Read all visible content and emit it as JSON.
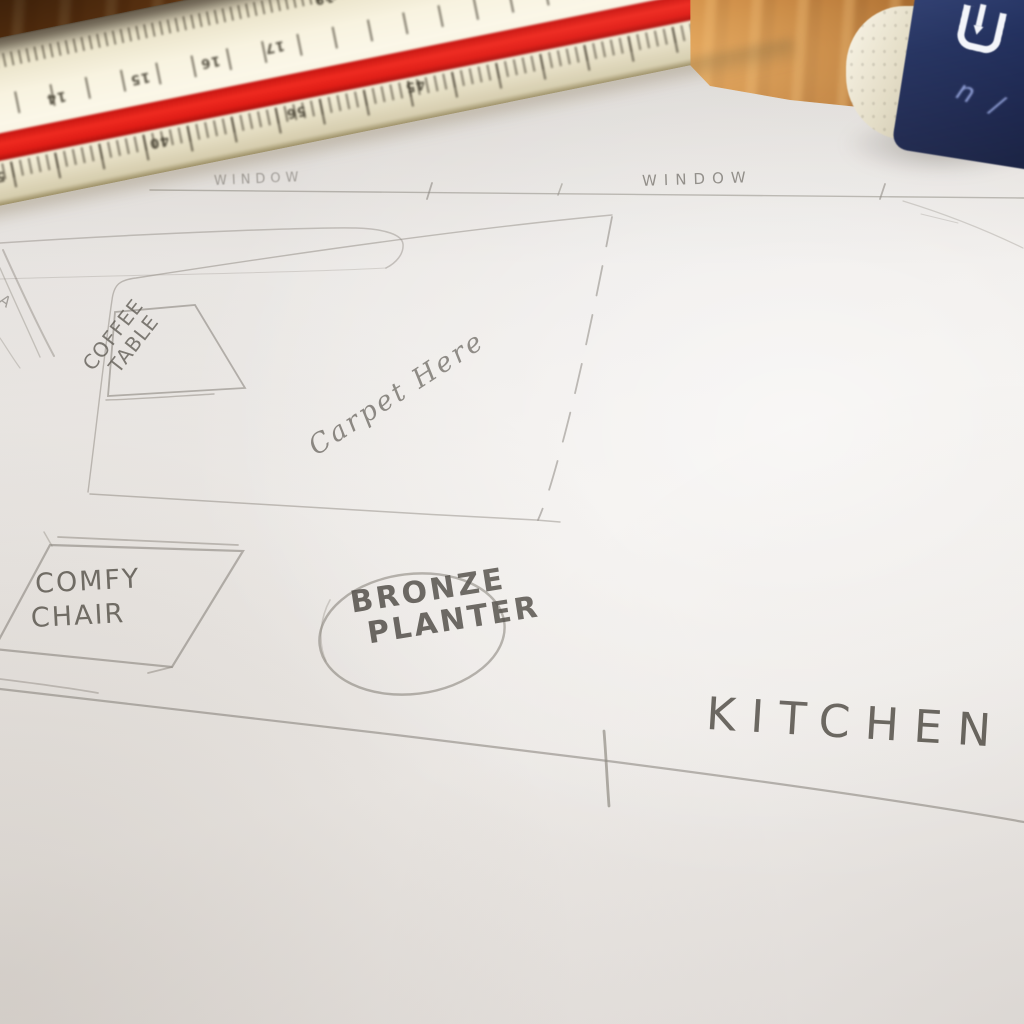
{
  "sketch_labels": {
    "window_left": "WINDOW",
    "window_right": "WINDOW",
    "coffee_table_line1": "COFFEE",
    "coffee_table_line2": "TABLE",
    "carpet_note": "Carpet Here",
    "comfy_chair_line1": "COMFY",
    "comfy_chair_line2": "CHAIR",
    "planter_line1": "BRONZE",
    "planter_line2": "PLANTER",
    "kitchen": "KITCHEN",
    "margin_mark": "A"
  },
  "ruler": {
    "scale_label": "20",
    "top_edge_numbers": [
      "19",
      "21"
    ],
    "mid_numbers": [
      "14",
      "15",
      "16",
      "17"
    ],
    "lower_numbers": [
      "55",
      "40",
      "56",
      "45"
    ],
    "body_color": "#f4efd9",
    "stripe_color": "#e4231d"
  },
  "eraser": {
    "logo_letter": "U",
    "pen_marks": "n /",
    "sleeve_color": "#1d2950",
    "body_color": "#e9e2cd"
  },
  "colors": {
    "wood": "#b06a28",
    "paper": "#edeae7",
    "pencil": "#6a665f"
  }
}
